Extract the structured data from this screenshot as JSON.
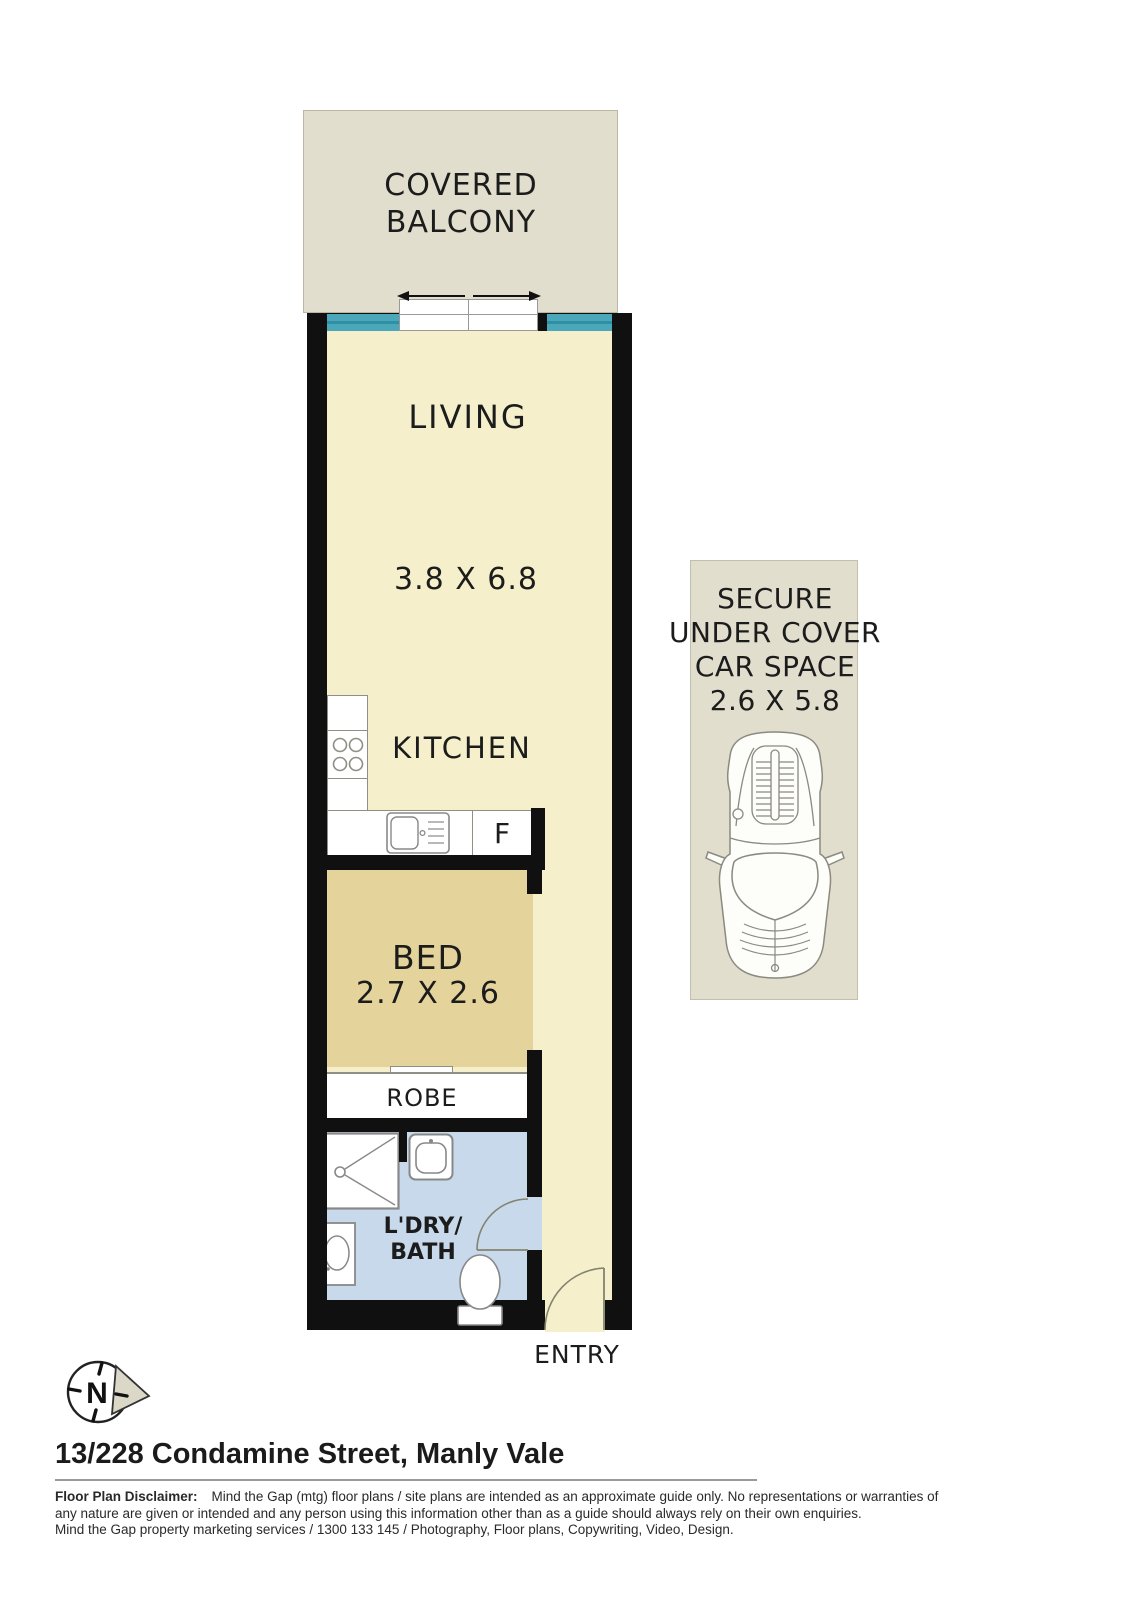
{
  "title": "Floor plan — 13/228 Condamine Street, Manly Vale",
  "plan": {
    "balcony": {
      "line1": "COVERED",
      "line2": "BALCONY"
    },
    "living": {
      "label": "LIVING",
      "dims": "3.8 X 6.8"
    },
    "kitchen": {
      "label": "KITCHEN",
      "fridge": "F"
    },
    "bed": {
      "label": "BED",
      "dims": "2.7 X 2.6"
    },
    "robe": {
      "label": "ROBE"
    },
    "bath": {
      "line1": "L'DRY/",
      "line2": "BATH"
    },
    "entry": {
      "label": "ENTRY"
    }
  },
  "carspace": {
    "line1": "SECURE",
    "line2": "UNDER COVER",
    "line3": "CAR SPACE",
    "dims": "2.6 X 5.8"
  },
  "compass": {
    "north": "N"
  },
  "footer": {
    "address": "13/228 Condamine Street, Manly Vale",
    "disclaimer_label": "Floor Plan Disclaimer:",
    "disclaimer_line1": "Mind the Gap (mtg) floor plans / site plans are intended as an approximate guide only. No representations or warranties of",
    "disclaimer_line2": "any nature are given or intended and any person using this information other than as a guide should always rely on their own enquiries.",
    "disclaimer_line3": "Mind the Gap property marketing services / 1300 133 145 / Photography, Floor plans, Copywriting, Video, Design."
  },
  "icons": {
    "compass": "north-compass-icon",
    "car": "car-top-view-icon",
    "stove": "stove-burners-icon",
    "sink": "kitchen-sink-icon",
    "shower": "shower-icon",
    "basin": "bathroom-basin-icon",
    "laundry": "laundry-tub-icon",
    "toilet": "toilet-icon",
    "sliding_door": "sliding-door-arrows-icon",
    "doors": "door-swing-icon"
  },
  "colors": {
    "wall": "#101010",
    "floor": "#f5f0cb",
    "bedroom": "#e5d39c",
    "bathroom": "#c9d9ec",
    "balcony": "#e1decd",
    "carspace": "#e1decd",
    "window": "#4ba7ba",
    "fixture_outline": "#8f8f85"
  }
}
